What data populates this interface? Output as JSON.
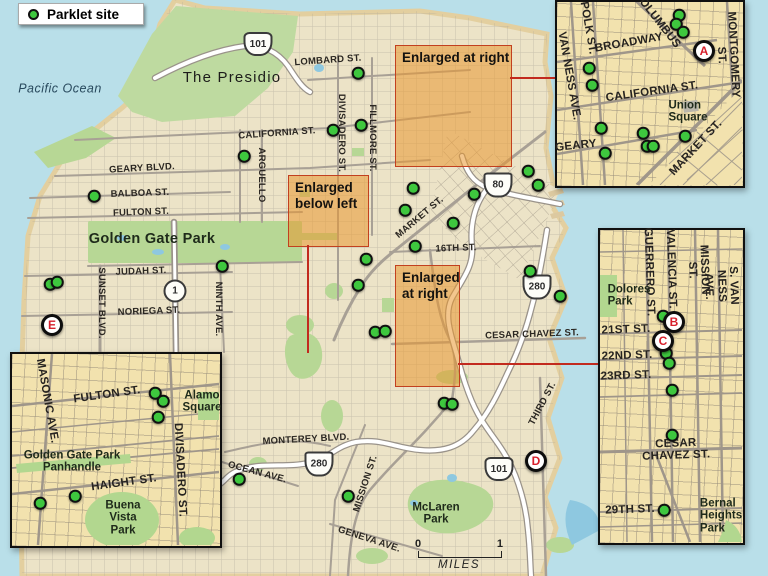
{
  "legend": {
    "label": "Parklet site",
    "dot_color": "#3ec73e"
  },
  "scale": {
    "start": "0",
    "end": "1",
    "unit": "MILES"
  },
  "colors": {
    "water": "#b9dfe9",
    "land": "#ece3c7",
    "park": "#b7d795",
    "inset_bg": "#f2e2ae",
    "enlarge_fill": "rgba(233,152,48,0.55)",
    "enlarge_border": "#c2401f",
    "connector_red": "#c22a1e",
    "dot_green": "#3ec73e",
    "marker_letter_red": "#d6202c"
  },
  "labels": [
    {
      "text": "Pacific Ocean",
      "x": 60,
      "y": 89,
      "rot": 0,
      "cls": "ocean"
    },
    {
      "text": "The Presidio",
      "x": 232,
      "y": 78,
      "rot": 0,
      "cls": "place"
    },
    {
      "text": "LOMBARD ST.",
      "x": 328,
      "y": 61,
      "rot": -4,
      "cls": "street"
    },
    {
      "text": "DIVISADERO ST.",
      "x": 341,
      "y": 133,
      "rot": 90,
      "cls": "street"
    },
    {
      "text": "FILLMORE ST.",
      "x": 372,
      "y": 138,
      "rot": 90,
      "cls": "street"
    },
    {
      "text": "CALIFORNIA ST.",
      "x": 277,
      "y": 134,
      "rot": -4,
      "cls": "street"
    },
    {
      "text": "ARGUELLO",
      "x": 261,
      "y": 175,
      "rot": 90,
      "cls": "street"
    },
    {
      "text": "GEARY BLVD.",
      "x": 142,
      "y": 169,
      "rot": -3,
      "cls": "street"
    },
    {
      "text": "BALBOA ST.",
      "x": 140,
      "y": 194,
      "rot": -2,
      "cls": "street"
    },
    {
      "text": "FULTON ST.",
      "x": 141,
      "y": 213,
      "rot": -2,
      "cls": "street"
    },
    {
      "text": "Golden Gate Park",
      "x": 152,
      "y": 240,
      "rot": 0,
      "cls": "park-big"
    },
    {
      "text": "SUNSET BLVD.",
      "x": 101,
      "y": 303,
      "rot": 90,
      "cls": "street"
    },
    {
      "text": "JUDAH ST.",
      "x": 141,
      "y": 272,
      "rot": -2,
      "cls": "street"
    },
    {
      "text": "NORIEGA ST.",
      "x": 149,
      "y": 312,
      "rot": -2,
      "cls": "street"
    },
    {
      "text": "NINTH AVE.",
      "x": 218,
      "y": 309,
      "rot": 90,
      "cls": "street"
    },
    {
      "text": "MARKET ST.",
      "x": 420,
      "y": 218,
      "rot": -40,
      "cls": "street"
    },
    {
      "text": "16TH  ST.",
      "x": 456,
      "y": 249,
      "rot": -2,
      "cls": "street"
    },
    {
      "text": "CESAR CHAVEZ ST.",
      "x": 532,
      "y": 335,
      "rot": -2,
      "cls": "street"
    },
    {
      "text": "MONTEREY BLVD.",
      "x": 306,
      "y": 440,
      "rot": -3,
      "cls": "street"
    },
    {
      "text": "OCEAN AVE.",
      "x": 257,
      "y": 473,
      "rot": 15,
      "cls": "street"
    },
    {
      "text": "MISSION ST.",
      "x": 366,
      "y": 484,
      "rot": -72,
      "cls": "street"
    },
    {
      "text": "GENEVA AVE.",
      "x": 369,
      "y": 540,
      "rot": 18,
      "cls": "street"
    },
    {
      "text": "McLaren\nPark",
      "x": 436,
      "y": 514,
      "rot": 0,
      "cls": "place-sm"
    },
    {
      "text": "THIRD ST.",
      "x": 543,
      "y": 404,
      "rot": -62,
      "cls": "street"
    },
    {
      "text": "POLK ST.",
      "x": 588,
      "y": 28,
      "rot": 80,
      "cls": "street-lg"
    },
    {
      "text": "VAN NESS AVE.",
      "x": 569,
      "y": 76,
      "rot": 80,
      "cls": "street-lg"
    },
    {
      "text": "BROADWAY",
      "x": 629,
      "y": 43,
      "rot": -10,
      "cls": "street-lg"
    },
    {
      "text": "COLUMBUS",
      "x": 657,
      "y": 20,
      "rot": 52,
      "cls": "street-lg"
    },
    {
      "text": "MONTGOMERY ST.",
      "x": 727,
      "y": 55,
      "rot": 87,
      "cls": "street-lg"
    },
    {
      "text": "CALIFORNIA ST.",
      "x": 652,
      "y": 92,
      "rot": -8,
      "cls": "street-lg"
    },
    {
      "text": "Union\nSquare",
      "x": 688,
      "y": 112,
      "rot": 0,
      "cls": "place-sm",
      "align": "left"
    },
    {
      "text": "GEARY",
      "x": 576,
      "y": 146,
      "rot": -6,
      "cls": "street-lg"
    },
    {
      "text": "MARKET ST.",
      "x": 696,
      "y": 148,
      "rot": -47,
      "cls": "street-lg"
    },
    {
      "text": "GUERRERO ST.",
      "x": 649,
      "y": 272,
      "rot": 88,
      "cls": "street-lg"
    },
    {
      "text": "VALENCIA ST.",
      "x": 671,
      "y": 269,
      "rot": 88,
      "cls": "street-lg"
    },
    {
      "text": "MISSION ST.",
      "x": 698,
      "y": 270,
      "rot": 88,
      "cls": "street-lg"
    },
    {
      "text": "S. VAN NESS AVE.",
      "x": 721,
      "y": 286,
      "rot": 88,
      "cls": "street-lg"
    },
    {
      "text": "Dolores\nPark",
      "x": 629,
      "y": 296,
      "rot": 0,
      "cls": "place-sm",
      "align": "left"
    },
    {
      "text": "21ST ST.",
      "x": 626,
      "y": 330,
      "rot": -2,
      "cls": "street-lg"
    },
    {
      "text": "22ND ST.",
      "x": 627,
      "y": 356,
      "rot": -2,
      "cls": "street-lg"
    },
    {
      "text": "23RD ST.",
      "x": 626,
      "y": 376,
      "rot": -2,
      "cls": "street-lg"
    },
    {
      "text": "CESAR CHAVEZ ST.",
      "x": 676,
      "y": 450,
      "rot": -2,
      "cls": "street-lg"
    },
    {
      "text": "29TH ST.",
      "x": 630,
      "y": 510,
      "rot": -2,
      "cls": "street-lg"
    },
    {
      "text": "Bernal\nHeights\nPark",
      "x": 721,
      "y": 516,
      "rot": 0,
      "cls": "place-sm",
      "align": "left"
    },
    {
      "text": "MASONIC AVE.",
      "x": 47,
      "y": 401,
      "rot": 80,
      "cls": "street-lg"
    },
    {
      "text": "FULTON ST.",
      "x": 107,
      "y": 395,
      "rot": -8,
      "cls": "street-lg"
    },
    {
      "text": "Alamo\nSquare",
      "x": 202,
      "y": 402,
      "rot": 0,
      "cls": "place-sm"
    },
    {
      "text": "DIVISADERO ST.",
      "x": 180,
      "y": 470,
      "rot": 87,
      "cls": "street-lg"
    },
    {
      "text": "Golden Gate Park\nPanhandle",
      "x": 72,
      "y": 462,
      "rot": 0,
      "cls": "place-sm"
    },
    {
      "text": "HAIGHT ST.",
      "x": 124,
      "y": 483,
      "rot": -8,
      "cls": "street-lg"
    },
    {
      "text": "Buena\nVista\nPark",
      "x": 123,
      "y": 518,
      "rot": 0,
      "cls": "place-sm"
    }
  ],
  "enlarged_boxes": [
    {
      "label": "Enlarged at right",
      "x": 395,
      "y": 45,
      "w": 115,
      "h": 120
    },
    {
      "label": "Enlarged\nbelow left",
      "x": 288,
      "y": 175,
      "w": 79,
      "h": 70
    },
    {
      "label": "Enlarged\nat right",
      "x": 395,
      "y": 265,
      "w": 63,
      "h": 120
    }
  ],
  "connectors": [
    {
      "x": 510,
      "y": 77,
      "w": 46,
      "h": 2
    },
    {
      "x": 458,
      "y": 363,
      "w": 141,
      "h": 2
    },
    {
      "x": 307,
      "y": 245,
      "w": 2,
      "h": 108
    }
  ],
  "markers": [
    {
      "letter": "A",
      "x": 704,
      "y": 51
    },
    {
      "letter": "B",
      "x": 674,
      "y": 322
    },
    {
      "letter": "C",
      "x": 663,
      "y": 341
    },
    {
      "letter": "D",
      "x": 536,
      "y": 461
    },
    {
      "letter": "E",
      "x": 52,
      "y": 325
    }
  ],
  "highway_shields": [
    {
      "type": "us",
      "label": "101",
      "x": 258,
      "y": 44
    },
    {
      "type": "circle",
      "label": "1",
      "x": 175,
      "y": 291
    },
    {
      "type": "interstate",
      "label": "80",
      "x": 498,
      "y": 185
    },
    {
      "type": "interstate",
      "label": "280",
      "x": 537,
      "y": 287
    },
    {
      "type": "interstate",
      "label": "280",
      "x": 319,
      "y": 464
    },
    {
      "type": "us",
      "label": "101",
      "x": 499,
      "y": 469
    }
  ],
  "parklet_dots": [
    [
      358,
      73
    ],
    [
      333,
      130
    ],
    [
      361,
      125
    ],
    [
      244,
      156
    ],
    [
      94,
      196
    ],
    [
      50,
      284
    ],
    [
      57,
      282
    ],
    [
      222,
      266
    ],
    [
      413,
      188
    ],
    [
      474,
      194
    ],
    [
      405,
      210
    ],
    [
      528,
      171
    ],
    [
      538,
      185
    ],
    [
      453,
      223
    ],
    [
      415,
      246
    ],
    [
      366,
      259
    ],
    [
      358,
      285
    ],
    [
      375,
      332
    ],
    [
      385,
      331
    ],
    [
      530,
      271
    ],
    [
      560,
      296
    ],
    [
      444,
      403
    ],
    [
      452,
      404
    ],
    [
      348,
      496
    ],
    [
      239,
      479
    ],
    [
      679,
      15
    ],
    [
      676,
      24
    ],
    [
      683,
      32
    ],
    [
      589,
      68
    ],
    [
      592,
      85
    ],
    [
      601,
      128
    ],
    [
      643,
      133
    ],
    [
      685,
      136
    ],
    [
      605,
      153
    ],
    [
      647,
      146
    ],
    [
      653,
      146
    ],
    [
      663,
      316
    ],
    [
      666,
      353
    ],
    [
      669,
      363
    ],
    [
      672,
      390
    ],
    [
      672,
      435
    ],
    [
      664,
      510
    ],
    [
      155,
      393
    ],
    [
      163,
      401
    ],
    [
      158,
      417
    ],
    [
      40,
      503
    ],
    [
      75,
      496
    ]
  ]
}
